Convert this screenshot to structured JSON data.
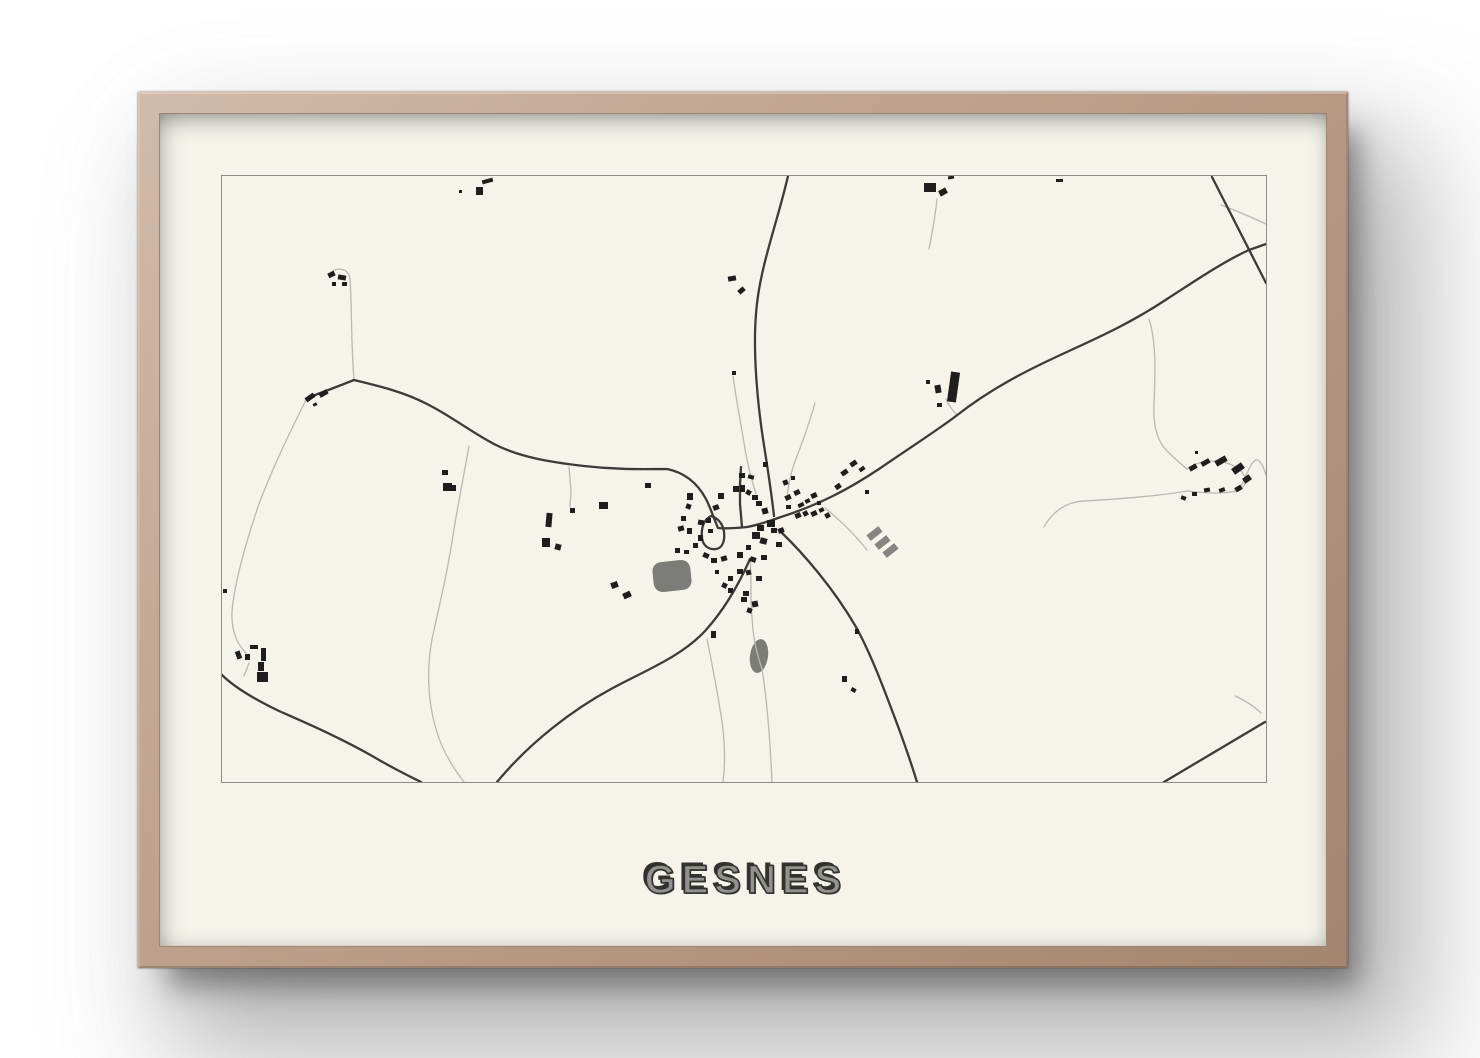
{
  "poster": {
    "title": "GESNES"
  },
  "colors": {
    "wall": "#ffffff",
    "frame_wood": "#bfa18d",
    "frame_wood_light": "#d2bba9",
    "frame_wood_dark": "#a3866f",
    "matte": "#f5f3ea",
    "map_border": "#8c8c86",
    "road_major": "#3b3b38",
    "road_minor": "#b9b9b2",
    "building": "#1e1e1c",
    "water": "#7c7c79",
    "bars": "#858583",
    "title_fill": "#92928f",
    "title_shadow": "#32322e"
  },
  "map": {
    "viewbox": "223 177 1044 606",
    "roads_major": [
      "M789 177 C778 225 760 270 757 315 C754 352 758 400 764 440 C768 465 772 490 775 517",
      "M779 519 C820 506 850 490 880 470 C915 446 940 430 957 417 C995 387 1035 368 1070 352 C1105 336 1135 322 1168 300 C1190 286 1225 262 1250 251 L1267 245",
      "M1213 178 L1267 284",
      "M355 381 C380 387 405 393 428 405 C452 417 472 433 495 445 C520 458 550 463 585 467 C620 471 645 470 668 470 C688 474 700 487 707 500 C712 510 715 520 719 529 C728 530 738 529 748 528 C760 526 770 522 779 519",
      "M355 381 L332 390 L308 399",
      "M223 676 C235 688 255 700 280 712 C305 723 340 738 375 758 C395 770 408 776 422 783",
      "M781 532 C805 555 835 590 857 628 C872 655 885 690 900 730 C908 752 914 770 918 783",
      "M751 560 C740 585 726 610 706 632 C682 658 645 672 612 690 C575 710 532 742 498 783",
      "M1165 783 L1266 723",
      "M743 528 L741 505 L741 486 L742 468",
      "M712 517 C704 521 702 530 703 539 C704 547 710 551 717 550 C724 549 726 541 725 533 C724 525 719 519 712 517"
    ],
    "roads_minor": [
      "M330 275 C337 267 350 269 351 280 C353 310 352 345 355 381",
      "M308 399 C295 425 275 465 260 505 C248 540 236 580 233 612 C232 632 238 645 247 654",
      "M250 664 L245 677",
      "M470 447 C466 470 460 500 455 530 C450 565 442 600 433 640 C428 668 428 700 437 730 C443 752 455 770 465 783",
      "M570 468 L572 492 L571 508",
      "M734 377 C737 400 742 425 746 450 C749 468 753 482 757 495",
      "M816 404 C810 425 803 445 795 465 C791 477 789 488 788 499",
      "M826 509 C842 522 857 537 868 551",
      "M751 560 C753 580 751 600 753 618 C754 640 758 655 763 670 C768 700 771 740 773 783",
      "M708 640 C714 670 720 700 724 730 C726 750 726 768 724 783",
      "M938 200 C936 220 933 235 930 250",
      "M947 400 C950 407 954 412 958 416",
      "M1150 320 C1158 345 1156 380 1155 405 C1154 425 1158 442 1168 452 C1175 459 1182 465 1188 470",
      "M1188 492 C1160 497 1120 500 1085 502 C1065 503 1052 515 1045 528",
      "M1188 470 C1205 458 1230 460 1243 473 C1248 479 1247 486 1242 490 C1230 496 1205 494 1188 492",
      "M1242 487 C1250 470 1254 459 1259 461 C1263 464 1265 470 1267 476",
      "M1236 697 C1247 702 1255 707 1262 714",
      "M1222 206 C1238 212 1252 218 1267 225"
    ],
    "waters": [
      {
        "type": "rect",
        "x": 654,
        "y": 562,
        "w": 38,
        "h": 30,
        "rx": 9,
        "rot": -6
      },
      {
        "type": "ellipse",
        "cx": 760,
        "cy": 657,
        "rx": 9,
        "ry": 17,
        "rot": 8
      }
    ],
    "bars": [
      [
        868,
        531,
        15,
        7,
        -38
      ],
      [
        876,
        540,
        15,
        7,
        -38
      ],
      [
        884,
        548,
        15,
        7,
        -38
      ]
    ],
    "buildings": [
      [
        460,
        191,
        3,
        3,
        0
      ],
      [
        477,
        188,
        7,
        8,
        0
      ],
      [
        483,
        180,
        11,
        4,
        -15
      ],
      [
        329,
        273,
        7,
        5,
        -25
      ],
      [
        339,
        276,
        8,
        5,
        10
      ],
      [
        333,
        283,
        4,
        4,
        0
      ],
      [
        343,
        283,
        5,
        4,
        0
      ],
      [
        306,
        396,
        10,
        5,
        -35
      ],
      [
        320,
        392,
        9,
        5,
        -30
      ],
      [
        314,
        404,
        4,
        3,
        -30
      ],
      [
        443,
        471,
        6,
        5,
        0
      ],
      [
        444,
        484,
        9,
        8,
        0
      ],
      [
        453,
        486,
        4,
        6,
        0
      ],
      [
        729,
        277,
        8,
        5,
        -10
      ],
      [
        739,
        289,
        7,
        5,
        -40
      ],
      [
        733,
        372,
        4,
        4,
        0
      ],
      [
        925,
        184,
        12,
        9,
        0
      ],
      [
        940,
        190,
        8,
        6,
        -30
      ],
      [
        949,
        177,
        6,
        3,
        -10
      ],
      [
        1057,
        180,
        7,
        3,
        0
      ],
      [
        950,
        373,
        9,
        30,
        8
      ],
      [
        936,
        386,
        6,
        8,
        -10
      ],
      [
        927,
        381,
        4,
        4,
        0
      ],
      [
        938,
        404,
        5,
        4,
        0
      ],
      [
        600,
        503,
        9,
        7,
        0
      ],
      [
        547,
        514,
        6,
        14,
        5
      ],
      [
        543,
        539,
        8,
        9,
        0
      ],
      [
        556,
        545,
        6,
        6,
        15
      ],
      [
        571,
        509,
        5,
        5,
        0
      ],
      [
        612,
        583,
        7,
        6,
        -20
      ],
      [
        624,
        593,
        8,
        6,
        -25
      ],
      [
        646,
        484,
        6,
        5,
        0
      ],
      [
        688,
        494,
        6,
        7,
        0
      ],
      [
        687,
        505,
        5,
        5,
        20
      ],
      [
        682,
        517,
        5,
        5,
        0
      ],
      [
        679,
        527,
        6,
        5,
        -15
      ],
      [
        688,
        529,
        5,
        6,
        0
      ],
      [
        676,
        549,
        5,
        5,
        0
      ],
      [
        685,
        551,
        5,
        4,
        0
      ],
      [
        699,
        521,
        6,
        5,
        10
      ],
      [
        707,
        519,
        5,
        5,
        0
      ],
      [
        714,
        506,
        6,
        5,
        -20
      ],
      [
        719,
        494,
        6,
        6,
        0
      ],
      [
        699,
        536,
        5,
        6,
        0
      ],
      [
        694,
        544,
        5,
        5,
        0
      ],
      [
        704,
        554,
        6,
        5,
        25
      ],
      [
        712,
        559,
        6,
        5,
        0
      ],
      [
        722,
        557,
        6,
        5,
        -15
      ],
      [
        709,
        530,
        5,
        4,
        0
      ],
      [
        734,
        487,
        6,
        6,
        0
      ],
      [
        741,
        486,
        5,
        7,
        0
      ],
      [
        747,
        491,
        5,
        5,
        30
      ],
      [
        753,
        496,
        6,
        5,
        0
      ],
      [
        740,
        474,
        6,
        5,
        0
      ],
      [
        749,
        476,
        6,
        4,
        15
      ],
      [
        764,
        463,
        5,
        5,
        0
      ],
      [
        757,
        502,
        6,
        5,
        0
      ],
      [
        763,
        509,
        6,
        6,
        -15
      ],
      [
        768,
        521,
        8,
        7,
        0
      ],
      [
        758,
        526,
        7,
        6,
        0
      ],
      [
        753,
        533,
        8,
        7,
        0
      ],
      [
        761,
        539,
        7,
        6,
        15
      ],
      [
        772,
        529,
        6,
        5,
        0
      ],
      [
        779,
        529,
        6,
        5,
        -20
      ],
      [
        777,
        543,
        6,
        5,
        0
      ],
      [
        747,
        546,
        5,
        5,
        0
      ],
      [
        738,
        553,
        6,
        6,
        0
      ],
      [
        751,
        558,
        6,
        5,
        20
      ],
      [
        762,
        556,
        6,
        5,
        0
      ],
      [
        738,
        570,
        6,
        5,
        0
      ],
      [
        747,
        571,
        5,
        5,
        -15
      ],
      [
        757,
        577,
        6,
        5,
        0
      ],
      [
        729,
        577,
        5,
        5,
        0
      ],
      [
        723,
        584,
        5,
        5,
        25
      ],
      [
        729,
        589,
        5,
        5,
        0
      ],
      [
        744,
        592,
        6,
        5,
        0
      ],
      [
        753,
        602,
        6,
        6,
        -10
      ],
      [
        716,
        571,
        4,
        4,
        0
      ],
      [
        786,
        496,
        6,
        5,
        -25
      ],
      [
        795,
        491,
        6,
        5,
        -25
      ],
      [
        799,
        504,
        6,
        4,
        -25
      ],
      [
        806,
        500,
        5,
        4,
        -25
      ],
      [
        812,
        494,
        6,
        5,
        -25
      ],
      [
        796,
        514,
        6,
        5,
        -25
      ],
      [
        804,
        512,
        5,
        5,
        -30
      ],
      [
        812,
        512,
        6,
        5,
        -25
      ],
      [
        820,
        509,
        5,
        4,
        -25
      ],
      [
        826,
        514,
        5,
        5,
        -30
      ],
      [
        818,
        502,
        4,
        4,
        0
      ],
      [
        787,
        506,
        5,
        4,
        0
      ],
      [
        784,
        481,
        5,
        5,
        -20
      ],
      [
        792,
        477,
        4,
        4,
        0
      ],
      [
        836,
        485,
        6,
        5,
        -35
      ],
      [
        842,
        471,
        7,
        5,
        -35
      ],
      [
        851,
        462,
        7,
        5,
        -35
      ],
      [
        860,
        468,
        6,
        4,
        -35
      ],
      [
        866,
        491,
        4,
        4,
        0
      ],
      [
        712,
        632,
        5,
        7,
        0
      ],
      [
        742,
        598,
        6,
        5,
        0
      ],
      [
        748,
        609,
        5,
        5,
        20
      ],
      [
        843,
        677,
        5,
        6,
        0
      ],
      [
        852,
        689,
        5,
        4,
        30
      ],
      [
        856,
        630,
        4,
        5,
        0
      ],
      [
        237,
        652,
        5,
        8,
        -20
      ],
      [
        246,
        655,
        5,
        6,
        0
      ],
      [
        251,
        646,
        8,
        4,
        0
      ],
      [
        262,
        649,
        5,
        13,
        0
      ],
      [
        259,
        663,
        6,
        9,
        0
      ],
      [
        258,
        673,
        11,
        10,
        0
      ],
      [
        224,
        590,
        4,
        4,
        0
      ],
      [
        1190,
        466,
        8,
        5,
        -30
      ],
      [
        1202,
        461,
        9,
        5,
        -30
      ],
      [
        1216,
        459,
        12,
        6,
        -30
      ],
      [
        1233,
        466,
        12,
        7,
        -35
      ],
      [
        1244,
        477,
        8,
        6,
        -35
      ],
      [
        1236,
        487,
        7,
        5,
        -30
      ],
      [
        1220,
        489,
        6,
        4,
        -20
      ],
      [
        1205,
        489,
        6,
        4,
        -10
      ],
      [
        1193,
        493,
        5,
        4,
        0
      ],
      [
        1182,
        497,
        5,
        4,
        20
      ],
      [
        1196,
        452,
        3,
        3,
        0
      ]
    ]
  }
}
